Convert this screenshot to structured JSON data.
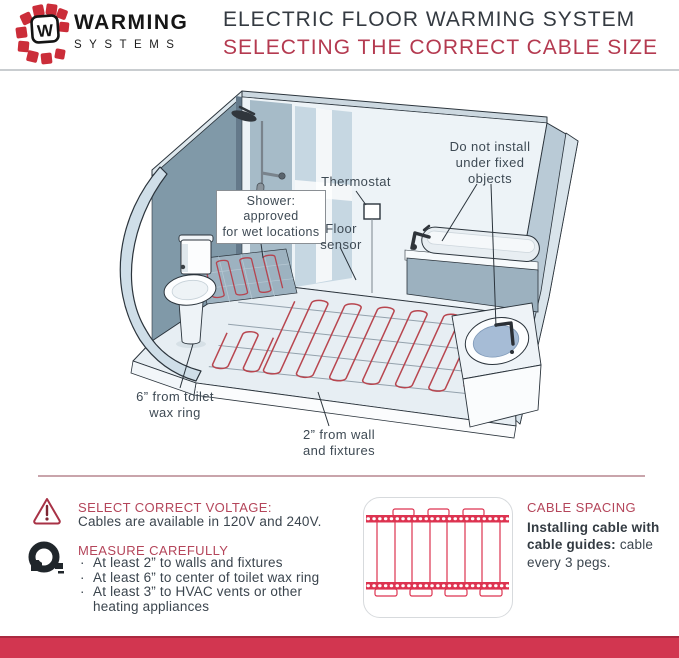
{
  "header": {
    "logo_letter": "W",
    "brand_line1": "WARMING",
    "brand_line2": "SYSTEMS",
    "title": "ELECTRIC FLOOR WARMING SYSTEM",
    "subtitle": "SELECTING THE CORRECT CABLE SIZE"
  },
  "diagram": {
    "labels": {
      "shower": "Shower: approved\nfor wet locations",
      "thermostat": "Thermostat",
      "floor_sensor": "Floor\nsensor",
      "fixed_objects": "Do not install\nunder fixed\nobjects",
      "toilet_clearance": "6” from toilet\nwax ring",
      "wall_clearance": "2” from wall\nand fixtures"
    }
  },
  "instructions": {
    "voltage": {
      "title": "SELECT CORRECT VOLTAGE:",
      "body": "Cables are available in 120V and 240V."
    },
    "measure": {
      "title": "MEASURE CAREFULLY",
      "bullets": [
        "At least 2” to walls and fixtures",
        "At least 6” to center of toilet wax ring",
        "At least 3” to HVAC vents or other heating appliances"
      ]
    },
    "spacing": {
      "title": "CABLE SPACING",
      "lead_bold": "Installing cable with cable guides:",
      "lead_rest": " cable every 3 pegs."
    }
  },
  "colors": {
    "accent_red": "#b4455a",
    "subtitle_red": "#b43a50",
    "band_red": "#d23650",
    "cable_red": "#b8464f",
    "logo_red": "#cb2d39"
  }
}
